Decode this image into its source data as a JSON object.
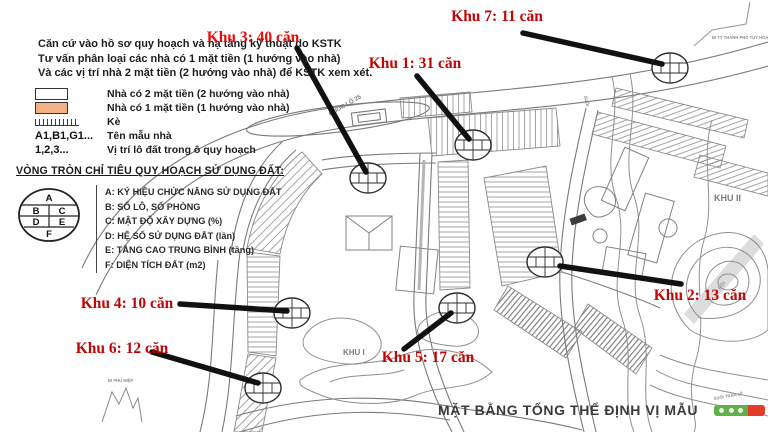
{
  "colors": {
    "label-red": "#c00505",
    "label-red-bright": "#ed0909",
    "legend-orange": "#f4b183",
    "logo-green": "#61b146",
    "logo-red": "#e03c28",
    "map-line": "#7a7a7a",
    "leader-black": "#111111"
  },
  "header": {
    "line1": "Căn cứ vào hồ sơ quy hoạch và hạ tầng kỹ thuật do KSTK",
    "line2": "Tư vấn phân loại các nhà có 1 mặt tiền (1 hướng vào nhà)",
    "line3": "Và các vị trí nhà 2 mặt tiền (2 hướng vào nhà) để KSTK xem xét."
  },
  "legend": {
    "items": [
      {
        "swatch": "white",
        "label": "Nhà có 2 mặt tiền (2 hướng vào nhà)"
      },
      {
        "swatch": "orange",
        "label": "Nhà có 1 mặt tiền (1 hướng vào nhà)"
      }
    ],
    "ke_label": "Kè",
    "ten_mau_key": "A1,B1,G1...",
    "ten_mau_label": "Tên mẫu nhà",
    "vi_tri_key": "1,2,3...",
    "vi_tri_label": "Vị trí lô đất trong ô quy hoạch"
  },
  "circle_legend": {
    "title": "VÒNG TRÒN CHỈ TIÊU QUY HOẠCH SỬ DỤNG ĐẤT:",
    "cells": [
      "A",
      "B",
      "C",
      "D",
      "E",
      "F"
    ],
    "items": [
      "A: KÝ HIỆU CHỨC NĂNG SỬ DỤNG ĐẤT",
      "B: SỐ LÔ, SỐ PHÒNG",
      "C: MẬT ĐỘ XÂY DỰNG (%)",
      "D: HỆ SỐ SỬ DỤNG ĐẤT (lần)",
      "E: TẦNG CAO TRUNG BÌNH (tầng)",
      "F: DIỆN TÍCH ĐẤT (m2)"
    ]
  },
  "annotations": [
    {
      "id": "khu3",
      "label": "Khu 3: 40 căn"
    },
    {
      "id": "khu7",
      "label": "Khu 7: 11 căn"
    },
    {
      "id": "khu1",
      "label": "Khu 1: 31 căn"
    },
    {
      "id": "khu2",
      "label": "Khu 2: 13 căn"
    },
    {
      "id": "khu4",
      "label": "Khu 4: 10 căn"
    },
    {
      "id": "khu6",
      "label": "Khu 6: 12 căn"
    },
    {
      "id": "khu5",
      "label": "Khu 5: 17 căn"
    }
  ],
  "map_labels": {
    "khu1_area": "KHU I",
    "khu2_area": "KHU II",
    "quoc_lo": "QUỐC LỘ 25",
    "di_tt": "ĐI TT THÀNH PHỐ TUY HÒA",
    "di_phu": "ĐI PHÚ HIỆP",
    "suoi_tran": "SUỐI TRẦN LỀ",
    "suoi": "SUỐI",
    "doi": "ĐỒI"
  },
  "footer": {
    "title": "MẶT BẰNG TỔNG THỂ  ĐỊNH VỊ MẪU",
    "page": "01"
  }
}
